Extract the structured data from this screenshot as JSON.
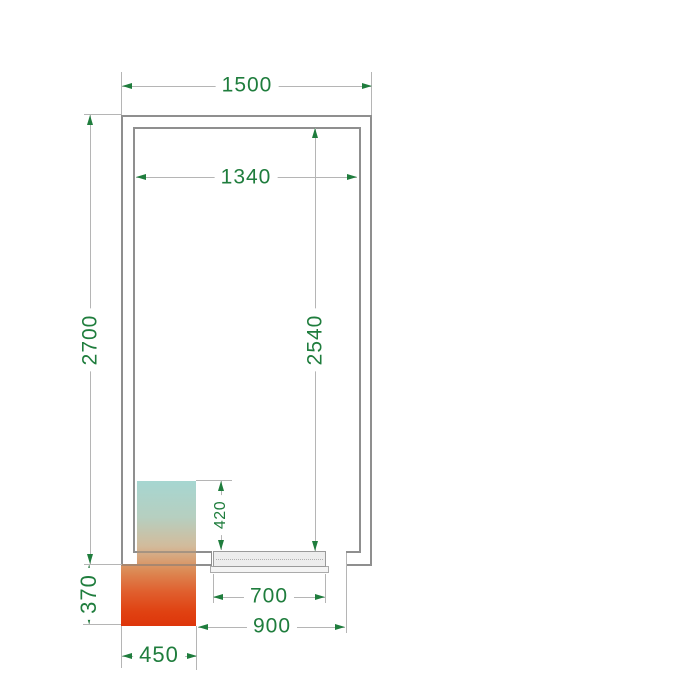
{
  "dimensions_mm": {
    "overall_width": "1500",
    "inner_width": "1340",
    "overall_depth": "2700",
    "inner_depth": "2540",
    "unit_recess_depth": "420",
    "unit_protrusion_depth": "370",
    "unit_width": "450",
    "door_opening_width": "700",
    "door_overall_width": "900"
  },
  "colors": {
    "dimension_text": "#1f7d3d",
    "dimension_lines": "#b5b5b5",
    "wall_outline": "#8f8f8f",
    "door_fill": "#ededed",
    "cooling_unit_gradient_top": "#a6d6d1",
    "cooling_unit_gradient_middle": "#d2bb9b",
    "cooling_unit_gradient_bottom": "#de350a"
  }
}
